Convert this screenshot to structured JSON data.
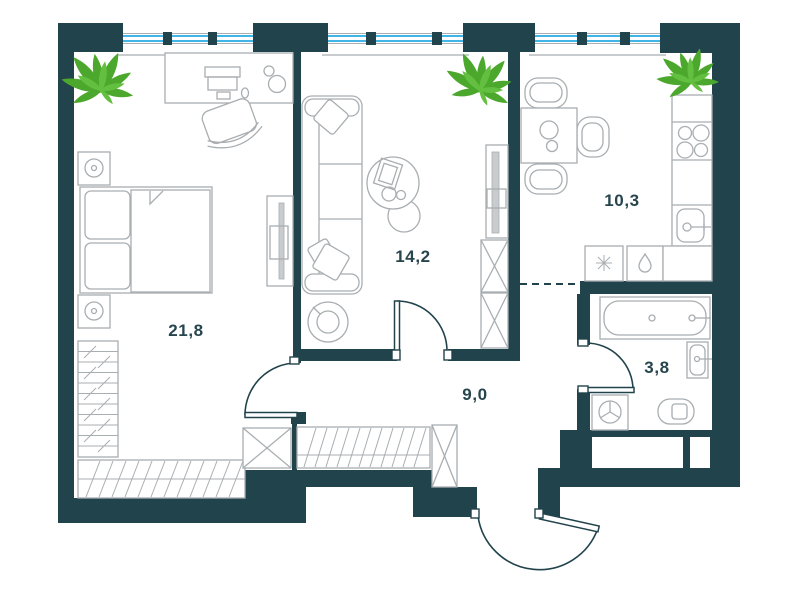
{
  "floor_plan": {
    "kind": "apartment-floor-plan",
    "area_labels": {
      "bedroom": "21,8",
      "living_room": "14,2",
      "hallway": "9,0",
      "kitchen": "10,3",
      "bathroom": "3,8"
    },
    "colors": {
      "wall": "#21434c",
      "furniture_line": "#a9aeb1",
      "panel_fill": "#c8ccce",
      "window_glass": "#41b6e6",
      "plant": "#4ba82c",
      "plant_light": "#63bf3f",
      "label_text": "#27454d",
      "background": "#ffffff"
    }
  }
}
